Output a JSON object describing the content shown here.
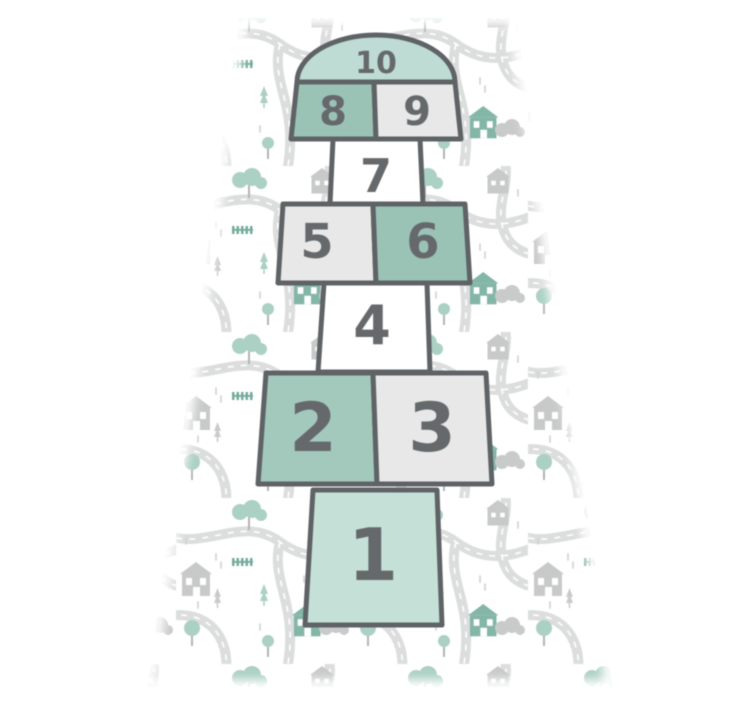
{
  "scene": {
    "description": "Hopscotch play mat with numbered court 1-10 on a kids road-map illustration background"
  },
  "court": {
    "cells": [
      {
        "id": "cell-1",
        "label": "1",
        "fill_key": "cell_mint"
      },
      {
        "id": "cell-2",
        "label": "2",
        "fill_key": "cell_teal_light"
      },
      {
        "id": "cell-3",
        "label": "3",
        "fill_key": "cell_gray"
      },
      {
        "id": "cell-4",
        "label": "4",
        "fill_key": "cell_white"
      },
      {
        "id": "cell-5",
        "label": "5",
        "fill_key": "cell_gray"
      },
      {
        "id": "cell-6",
        "label": "6",
        "fill_key": "cell_teal"
      },
      {
        "id": "cell-7",
        "label": "7",
        "fill_key": "cell_white"
      },
      {
        "id": "cell-8",
        "label": "8",
        "fill_key": "cell_teal"
      },
      {
        "id": "cell-9",
        "label": "9",
        "fill_key": "cell_gray"
      },
      {
        "id": "cell-10",
        "label": "10",
        "fill_key": "cell_dome_mint"
      }
    ]
  },
  "colors": {
    "background": "#ffffff",
    "cell_teal": "#9ac3b6",
    "cell_teal_light": "#a3c9bc",
    "cell_mint": "#c5e1d7",
    "cell_dome_mint": "#bedcd3",
    "cell_gray": "#e7e8e7",
    "cell_white": "#ffffff",
    "outline": "#5f6366",
    "number": "#66696b",
    "map_road": "#dcdedd",
    "map_road_dash": "#ffffff",
    "map_house_gray": "#c8cac9",
    "map_house_teal": "#84b6a8",
    "map_tree_mint": "#abd0c4",
    "map_tree_gray": "#c9cbca",
    "map_fence_teal": "#74ab9c",
    "map_rain_dash": "#d2d4d3",
    "map_trunk": "#b3b5b4"
  }
}
